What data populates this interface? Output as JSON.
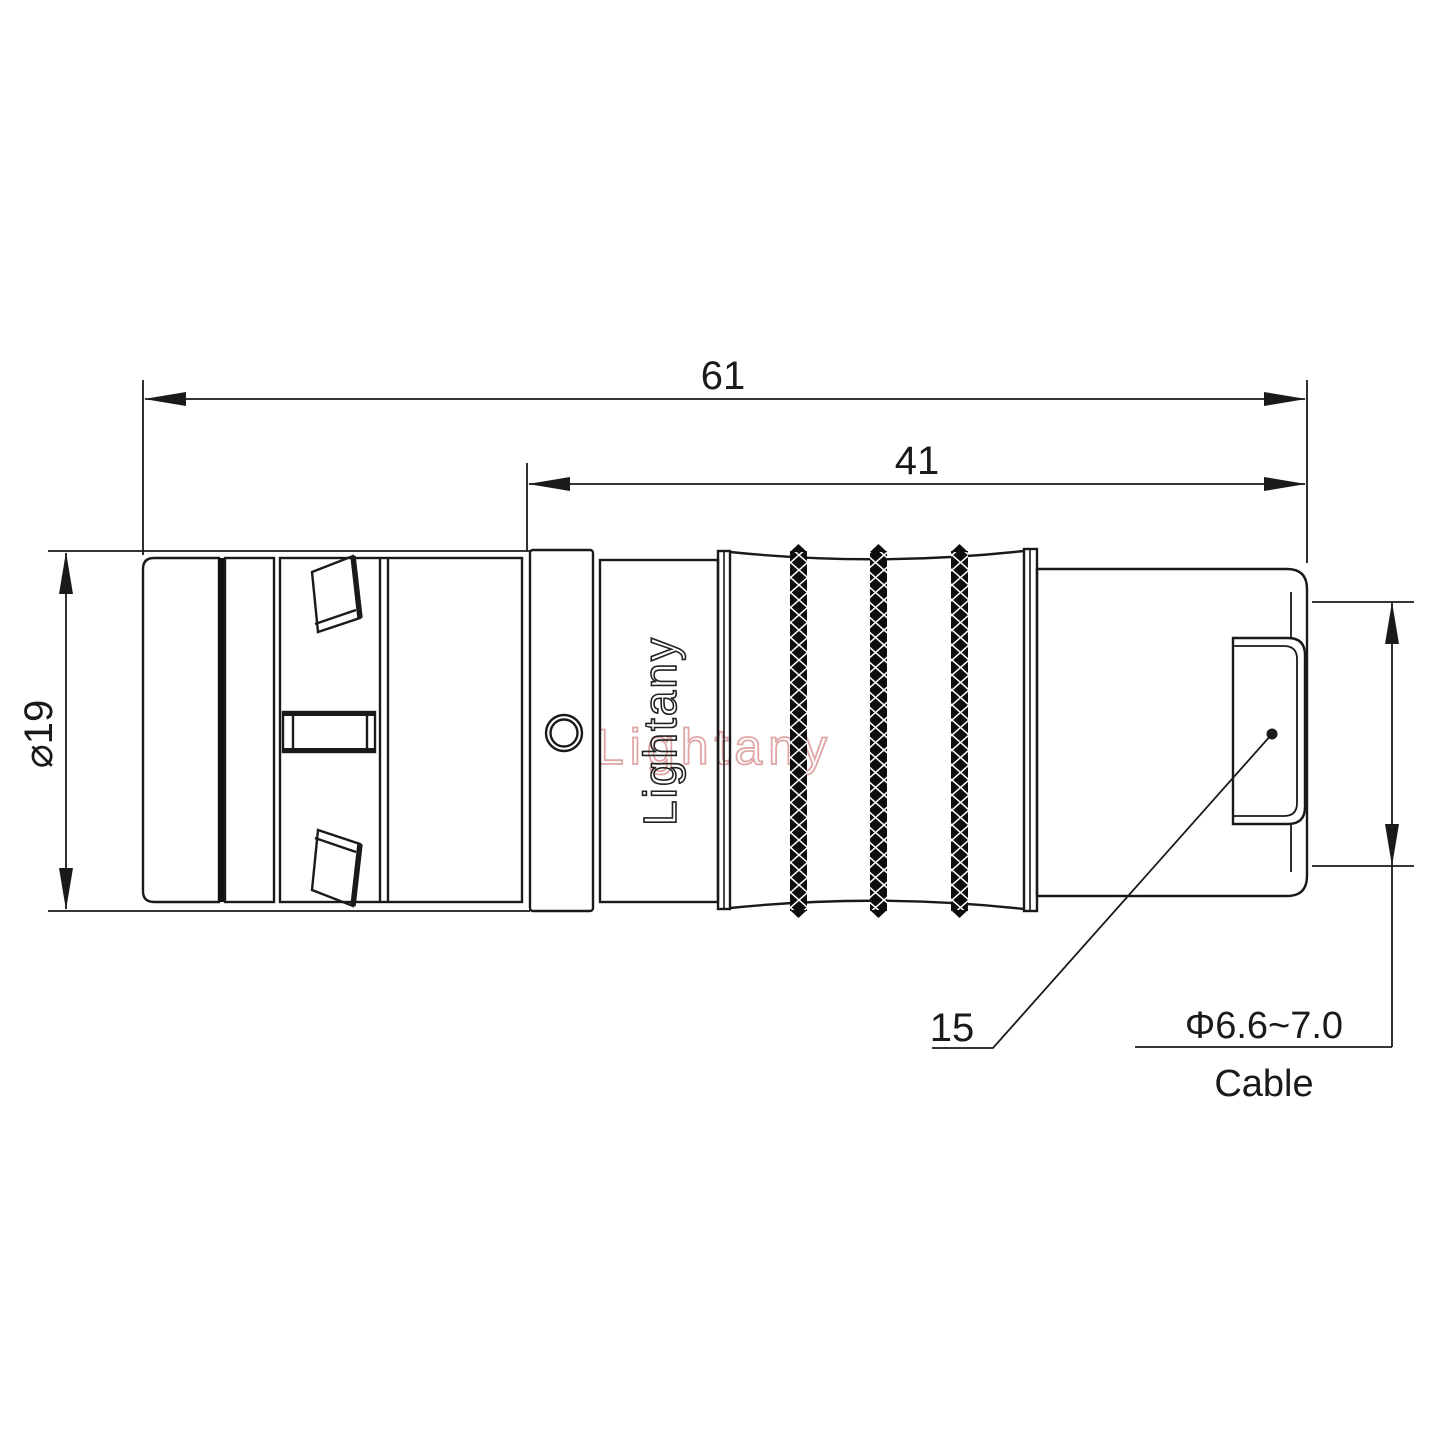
{
  "drawing": {
    "type": "connector-technical-drawing",
    "dimensions": {
      "overall_length": "61",
      "rear_section_length": "41",
      "body_diameter": "⌀19",
      "backshell_length": "15",
      "cable_diameter": "Φ6.6~7.0",
      "cable_label": "Cable"
    },
    "branding": {
      "engraved_text": "Lightany",
      "watermark_text": "Lightany"
    },
    "colors": {
      "line": "#1a1a1a",
      "watermark_pink": "#d98f8f",
      "background": "#ffffff"
    }
  }
}
